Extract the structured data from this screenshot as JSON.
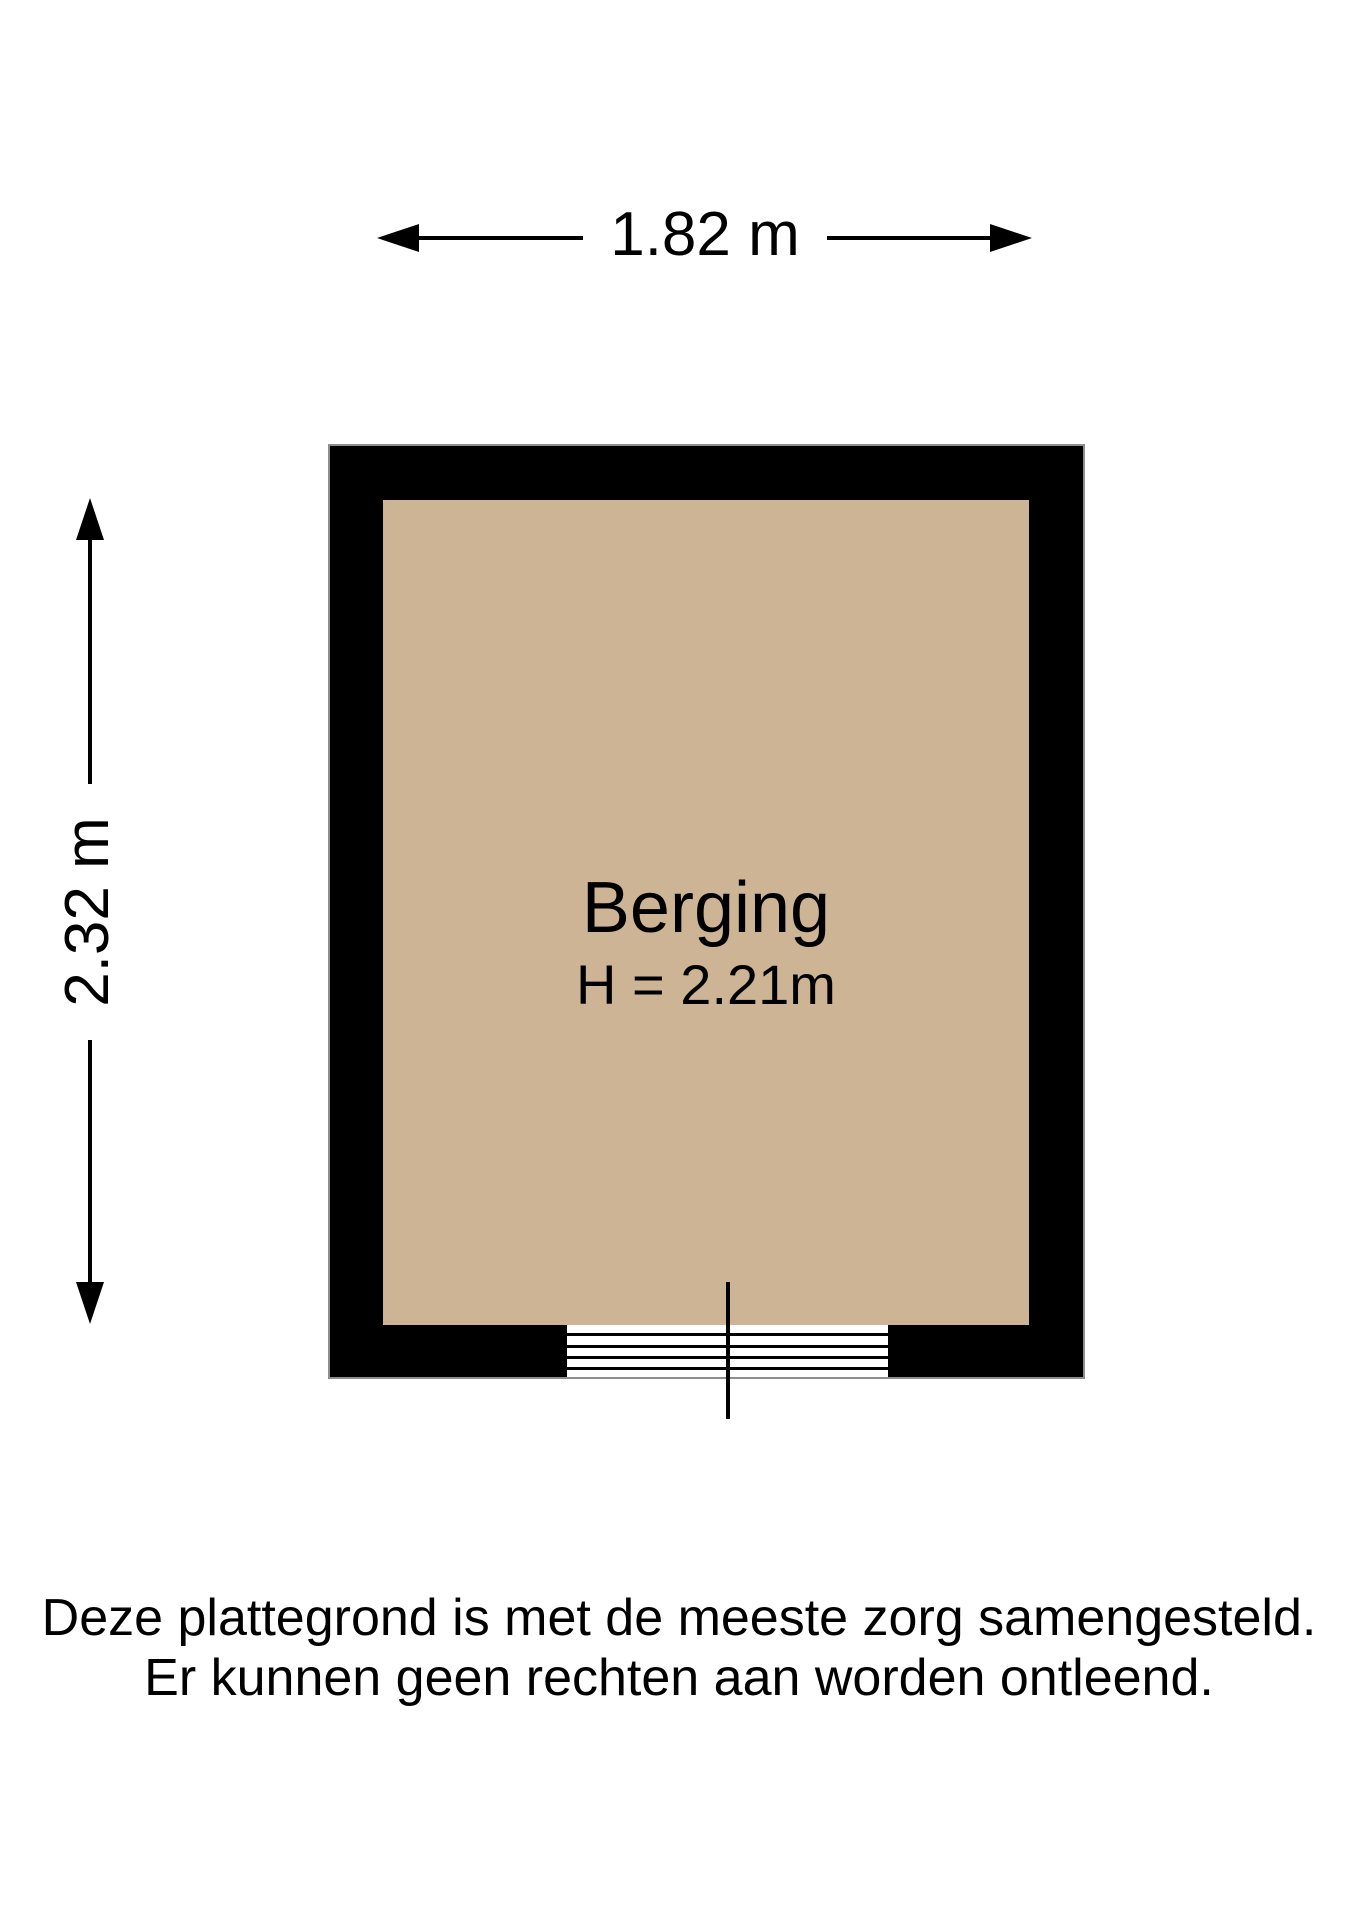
{
  "floorplan": {
    "room": {
      "name": "Berging",
      "ceiling_height_label": "H = 2.21m"
    },
    "dimensions": {
      "width_label": "1.82 m",
      "height_label": "2.32 m"
    },
    "colors": {
      "floor": "#ccb494",
      "wall": "#000000",
      "background": "#ffffff",
      "wall_outline": "#8e8e8e"
    },
    "disclaimer": {
      "line1": "Deze plattegrond is met de meeste zorg samengesteld.",
      "line2": "Er kunnen geen rechten aan worden ontleend."
    }
  }
}
